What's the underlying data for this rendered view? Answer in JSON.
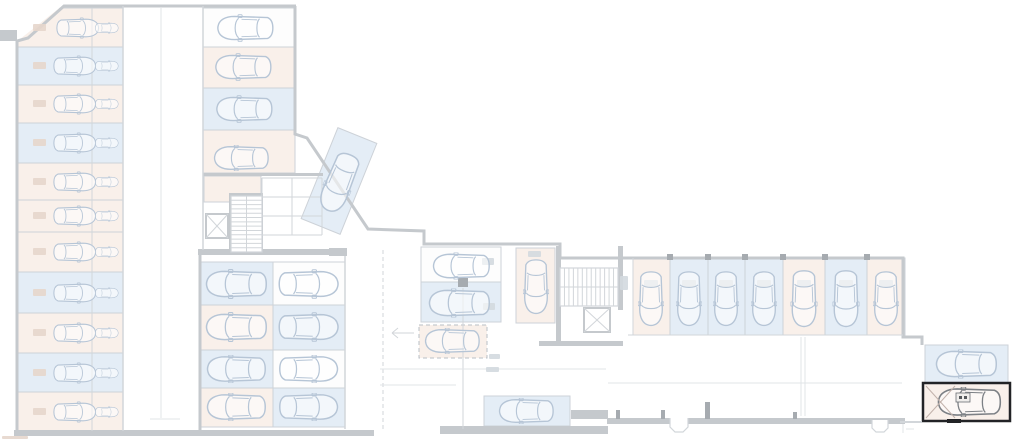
{
  "plan": {
    "kind": "underground-parking-floor-plan",
    "highlighted_space": {
      "present": true,
      "position": "bottom-right",
      "border_color": "#222326"
    }
  },
  "palette": {
    "wall": "#c5c9cd",
    "mid": "#d2d6da",
    "light": "#e1e4e7",
    "blue": "#e4edf6",
    "pink": "#f9f0ea",
    "white": "#fdfdfd",
    "carLight": "#b6c5d6",
    "carDark": "#7c8085",
    "highlight": "#222326",
    "hatch": "#c2b2ab",
    "smudgePink": "#e6d6cc",
    "smudgeGray": "#d3d9df",
    "column": "#a6abb0"
  },
  "spaces": [
    {
      "n": "left-r1",
      "x": 17,
      "y": 8,
      "w": 106,
      "h": 39,
      "f": "pink",
      "car": [
        78,
        28,
        44,
        28,
        0
      ],
      "car2": [
        107,
        28,
        24,
        24,
        0
      ],
      "sm": [
        33,
        24,
        13,
        7,
        "p"
      ]
    },
    {
      "n": "left-r2",
      "x": 17,
      "y": 47,
      "w": 106,
      "h": 38,
      "f": "blue",
      "car": [
        75,
        66,
        44,
        28,
        0
      ],
      "car2": [
        107,
        66,
        24,
        24,
        0
      ],
      "sm": [
        33,
        62,
        13,
        7,
        "p"
      ]
    },
    {
      "n": "left-r3",
      "x": 17,
      "y": 85,
      "w": 106,
      "h": 38,
      "f": "pink",
      "car": [
        75,
        104,
        44,
        28,
        0
      ],
      "car2": [
        107,
        104,
        24,
        24,
        0
      ],
      "sm": [
        33,
        100,
        13,
        7,
        "p"
      ]
    },
    {
      "n": "left-r4",
      "x": 17,
      "y": 123,
      "w": 106,
      "h": 40,
      "f": "blue",
      "car": [
        75,
        143,
        44,
        28,
        0
      ],
      "car2": [
        107,
        143,
        24,
        24,
        0
      ],
      "sm": [
        33,
        139,
        13,
        7,
        "p"
      ]
    },
    {
      "n": "left-r5",
      "x": 17,
      "y": 163,
      "w": 106,
      "h": 37,
      "f": "pink",
      "car": [
        75,
        182,
        44,
        28,
        0
      ],
      "car2": [
        107,
        182,
        24,
        24,
        0
      ],
      "sm": [
        33,
        178,
        13,
        7,
        "p"
      ]
    },
    {
      "n": "left-r6",
      "x": 17,
      "y": 200,
      "w": 106,
      "h": 32,
      "f": "pink",
      "car": [
        75,
        216,
        44,
        26,
        0
      ],
      "car2": [
        107,
        216,
        24,
        22,
        0
      ],
      "sm": [
        33,
        212,
        13,
        7,
        "p"
      ]
    },
    {
      "n": "left-r7",
      "x": 17,
      "y": 232,
      "w": 106,
      "h": 40,
      "f": "pink",
      "car": [
        75,
        252,
        44,
        28,
        0
      ],
      "car2": [
        107,
        252,
        24,
        24,
        0
      ],
      "sm": [
        33,
        248,
        13,
        7,
        "p"
      ]
    },
    {
      "n": "left-r8",
      "x": 17,
      "y": 272,
      "w": 106,
      "h": 41,
      "f": "blue",
      "car": [
        75,
        293,
        44,
        28,
        0
      ],
      "car2": [
        107,
        293,
        24,
        24,
        0
      ],
      "sm": [
        33,
        289,
        13,
        7,
        "p"
      ]
    },
    {
      "n": "left-r9",
      "x": 17,
      "y": 313,
      "w": 106,
      "h": 40,
      "f": "pink",
      "car": [
        75,
        333,
        44,
        28,
        0
      ],
      "car2": [
        107,
        333,
        24,
        24,
        0
      ],
      "sm": [
        33,
        329,
        13,
        7,
        "p"
      ]
    },
    {
      "n": "left-r10",
      "x": 17,
      "y": 353,
      "w": 106,
      "h": 39,
      "f": "blue",
      "car": [
        75,
        373,
        44,
        28,
        0
      ],
      "car2": [
        107,
        373,
        24,
        24,
        0
      ],
      "sm": [
        33,
        369,
        13,
        7,
        "p"
      ]
    },
    {
      "n": "left-r11",
      "x": 17,
      "y": 392,
      "w": 106,
      "h": 40,
      "f": "pink",
      "car": [
        75,
        412,
        44,
        28,
        0
      ],
      "car2": [
        107,
        412,
        24,
        24,
        0
      ],
      "sm": [
        33,
        408,
        13,
        7,
        "p"
      ]
    },
    {
      "n": "upper-r1",
      "x": 203,
      "y": 8,
      "w": 92,
      "h": 39,
      "f": "white",
      "car": [
        245,
        28,
        58,
        28,
        180
      ]
    },
    {
      "n": "upper-r2",
      "x": 203,
      "y": 47,
      "w": 92,
      "h": 41,
      "f": "pink",
      "car": [
        243,
        67,
        58,
        28,
        180
      ]
    },
    {
      "n": "upper-r3",
      "x": 203,
      "y": 88,
      "w": 92,
      "h": 42,
      "f": "blue",
      "car": [
        244,
        109,
        58,
        28,
        180
      ]
    },
    {
      "n": "upper-r4",
      "x": 203,
      "y": 130,
      "w": 92,
      "h": 43,
      "f": "pink",
      "car": [
        241,
        158,
        57,
        26,
        180
      ]
    },
    {
      "n": "store-room",
      "x": 204,
      "y": 176,
      "w": 57,
      "h": 26,
      "f": "pink"
    },
    {
      "n": "mid-left-r1",
      "x": 200,
      "y": 262,
      "w": 73,
      "h": 43,
      "f": "blue",
      "car": [
        236,
        284,
        63,
        30,
        180
      ]
    },
    {
      "n": "mid-left-r2",
      "x": 200,
      "y": 305,
      "w": 73,
      "h": 45,
      "f": "pink",
      "car": [
        236,
        327,
        63,
        30,
        180
      ]
    },
    {
      "n": "mid-left-r3",
      "x": 200,
      "y": 350,
      "w": 73,
      "h": 38,
      "f": "blue",
      "car": [
        236,
        369,
        63,
        28,
        180
      ]
    },
    {
      "n": "mid-left-r4",
      "x": 200,
      "y": 388,
      "w": 73,
      "h": 39,
      "f": "pink",
      "car": [
        236,
        407,
        63,
        28,
        180
      ]
    },
    {
      "n": "mid-right-r1",
      "x": 273,
      "y": 262,
      "w": 72,
      "h": 43,
      "f": "white",
      "car": [
        309,
        284,
        62,
        30,
        0
      ]
    },
    {
      "n": "mid-right-r2",
      "x": 273,
      "y": 305,
      "w": 72,
      "h": 45,
      "f": "blue",
      "car": [
        309,
        327,
        62,
        30,
        0
      ]
    },
    {
      "n": "mid-right-r3",
      "x": 273,
      "y": 350,
      "w": 72,
      "h": 38,
      "f": "white",
      "car": [
        309,
        369,
        62,
        28,
        0
      ]
    },
    {
      "n": "mid-right-r4",
      "x": 273,
      "y": 388,
      "w": 72,
      "h": 39,
      "f": "blue",
      "car": [
        309,
        407,
        62,
        28,
        0
      ]
    },
    {
      "n": "center-c1",
      "x": 421,
      "y": 247,
      "w": 80,
      "h": 35,
      "f": "white",
      "car": [
        461,
        266,
        62,
        27,
        180
      ],
      "sm": [
        482,
        258,
        12,
        7,
        "g"
      ]
    },
    {
      "n": "center-c2",
      "x": 421,
      "y": 282,
      "w": 80,
      "h": 40,
      "f": "blue",
      "car": [
        459,
        303,
        64,
        29,
        180
      ],
      "sm": [
        483,
        303,
        12,
        7,
        "g"
      ]
    },
    {
      "n": "center-c3",
      "x": 419,
      "y": 325,
      "w": 68,
      "h": 33,
      "f": "pink",
      "dash": true,
      "car": [
        452,
        341,
        62,
        26,
        180
      ]
    },
    {
      "n": "center-c4",
      "x": 516,
      "y": 248,
      "w": 39,
      "h": 75,
      "f": "pink",
      "car": [
        536,
        287,
        63,
        26,
        90
      ],
      "sm": [
        528,
        251,
        13,
        6,
        "g"
      ]
    },
    {
      "n": "diagonal",
      "x": 318,
      "y": 132,
      "w": 42,
      "h": 98,
      "f": "blue",
      "rot": 22,
      "car": [
        339,
        183,
        66,
        29,
        112
      ]
    },
    {
      "n": "wing-1",
      "x": 633,
      "y": 258,
      "w": 37,
      "h": 77,
      "f": "pink",
      "car": [
        651,
        299,
        62,
        26,
        90
      ],
      "sm": [
        644,
        280,
        14,
        7,
        "g"
      ]
    },
    {
      "n": "wing-2",
      "x": 670,
      "y": 258,
      "w": 38,
      "h": 77,
      "f": "blue",
      "car": [
        689,
        299,
        62,
        26,
        90
      ],
      "sm": [
        682,
        280,
        14,
        7,
        "g"
      ]
    },
    {
      "n": "wing-3",
      "x": 708,
      "y": 258,
      "w": 37,
      "h": 77,
      "f": "blue",
      "car": [
        726,
        299,
        62,
        26,
        90
      ],
      "sm": [
        719,
        280,
        14,
        7,
        "g"
      ]
    },
    {
      "n": "wing-4",
      "x": 745,
      "y": 258,
      "w": 38,
      "h": 77,
      "f": "blue",
      "car": [
        764,
        299,
        62,
        26,
        90
      ],
      "sm": [
        757,
        280,
        14,
        7,
        "g"
      ]
    },
    {
      "n": "wing-5",
      "x": 783,
      "y": 258,
      "w": 42,
      "h": 77,
      "f": "pink",
      "car": [
        804,
        299,
        62,
        27,
        90
      ],
      "sm": [
        797,
        280,
        14,
        7,
        "g"
      ]
    },
    {
      "n": "wing-6",
      "x": 825,
      "y": 258,
      "w": 42,
      "h": 77,
      "f": "blue",
      "car": [
        846,
        299,
        62,
        27,
        90
      ],
      "sm": [
        839,
        280,
        14,
        7,
        "g"
      ]
    },
    {
      "n": "wing-7",
      "x": 867,
      "y": 258,
      "w": 38,
      "h": 77,
      "f": "pink",
      "car": [
        886,
        299,
        62,
        26,
        90
      ],
      "sm": [
        879,
        280,
        14,
        7,
        "g"
      ]
    },
    {
      "n": "bottom-b1",
      "x": 484,
      "y": 396,
      "w": 86,
      "h": 30,
      "f": "blue",
      "car": [
        526,
        411,
        66,
        26,
        180
      ]
    },
    {
      "n": "right-r1",
      "x": 925,
      "y": 345,
      "w": 83,
      "h": 38,
      "f": "blue",
      "car": [
        966,
        364,
        70,
        29,
        180
      ]
    },
    {
      "n": "right-r2-selected",
      "x": 923,
      "y": 383,
      "w": 87,
      "h": 38,
      "f": "pink",
      "hl": true,
      "car": [
        969,
        402,
        72,
        30,
        180,
        "dark"
      ]
    }
  ],
  "stairs": [
    {
      "n": "stairs-core-left",
      "x": 231,
      "y": 196,
      "w": 31,
      "h": 56,
      "dir": "v",
      "steps": 13
    },
    {
      "n": "stairs-core-right",
      "x": 560,
      "y": 268,
      "w": 58,
      "h": 38,
      "dir": "h",
      "steps": 13
    }
  ],
  "elevators": [
    {
      "n": "elevator-left",
      "x": 206,
      "y": 214,
      "w": 22,
      "h": 24
    },
    {
      "n": "elevator-right",
      "x": 584,
      "y": 308,
      "w": 26,
      "h": 24
    }
  ],
  "wall_rects": [
    [
      0,
      30,
      17,
      11
    ],
    [
      198,
      249,
      149,
      6
    ],
    [
      329,
      248,
      18,
      8
    ],
    [
      14,
      430,
      360,
      6
    ],
    [
      440,
      426,
      168,
      8
    ],
    [
      571,
      410,
      37,
      9
    ],
    [
      607,
      418,
      298,
      6
    ],
    [
      539,
      341,
      84,
      5
    ],
    [
      556,
      246,
      5,
      99
    ],
    [
      618,
      246,
      5,
      64
    ],
    [
      229,
      193,
      34,
      3
    ],
    [
      229,
      193,
      3,
      62
    ],
    [
      260,
      193,
      3,
      62
    ],
    [
      203,
      173,
      120,
      3
    ]
  ],
  "lines": [
    [
      92,
      8,
      92,
      431,
      "m",
      1
    ],
    [
      123,
      6,
      123,
      431,
      "m",
      1.5
    ],
    [
      203,
      6,
      203,
      250,
      "m",
      1.5
    ],
    [
      161,
      8,
      161,
      418,
      "l",
      1
    ],
    [
      150,
      419,
      180,
      419,
      "l",
      1
    ],
    [
      345,
      256,
      345,
      429,
      "m",
      1.5
    ],
    [
      383,
      250,
      383,
      429,
      "m",
      1,
      "4,3"
    ],
    [
      463,
      288,
      463,
      429,
      "m",
      1
    ],
    [
      380,
      369,
      606,
      369,
      "l",
      1
    ],
    [
      380,
      385,
      456,
      385,
      "l",
      1
    ],
    [
      608,
      383,
      902,
      383,
      "l",
      1
    ],
    [
      801,
      337,
      801,
      416,
      "l",
      1
    ],
    [
      805,
      337,
      805,
      416,
      "l",
      1
    ],
    [
      900,
      422,
      922,
      422,
      "m",
      2
    ],
    [
      392,
      333,
      414,
      333,
      "m",
      1
    ],
    [
      392,
      333,
      398,
      328,
      "m",
      1
    ],
    [
      392,
      333,
      398,
      338,
      "m",
      1
    ],
    [
      628,
      335,
      903,
      335,
      "m",
      1
    ],
    [
      633,
      258,
      633,
      335,
      "m",
      1
    ],
    [
      262,
      178,
      262,
      235,
      "m",
      1
    ],
    [
      292,
      178,
      292,
      235,
      "m",
      1
    ],
    [
      322,
      178,
      322,
      235,
      "m",
      1
    ],
    [
      262,
      178,
      322,
      178,
      "m",
      1
    ],
    [
      262,
      197,
      322,
      197,
      "m",
      1
    ],
    [
      262,
      216,
      322,
      216,
      "m",
      1
    ],
    [
      262,
      235,
      322,
      235,
      "m",
      1
    ],
    [
      903,
      424,
      903,
      433,
      "l",
      1
    ],
    [
      906,
      429,
      914,
      429,
      "l",
      1
    ]
  ],
  "columns": [
    [
      458,
      278,
      10,
      9
    ],
    [
      667,
      254,
      6,
      6
    ],
    [
      705,
      254,
      6,
      6
    ],
    [
      742,
      254,
      6,
      6
    ],
    [
      780,
      254,
      6,
      6
    ],
    [
      822,
      254,
      6,
      6
    ],
    [
      864,
      254,
      6,
      6
    ],
    [
      616,
      410,
      4,
      9
    ],
    [
      661,
      410,
      4,
      9
    ],
    [
      705,
      402,
      5,
      17
    ],
    [
      793,
      412,
      4,
      7
    ]
  ],
  "fixtures": [
    "M670,418 v9 l5,5 h8 l5,-5 v-9",
    "M872,420 v8 l4,4 h8 l4,-4 v-8"
  ],
  "smudges_extra": [
    [
      489,
      354,
      11,
      5,
      "g"
    ],
    [
      486,
      367,
      13,
      5,
      "g"
    ],
    [
      2,
      436,
      26,
      3,
      "p"
    ],
    [
      620,
      276,
      8,
      14,
      "g"
    ]
  ],
  "highlight_extras": {
    "hatch": [
      [
        926,
        386,
        955,
        418
      ],
      [
        926,
        418,
        955,
        386
      ]
    ],
    "plate": {
      "x": 956,
      "y": 393,
      "w": 14,
      "h": 9
    },
    "plate_dots": [
      [
        959,
        396,
        3,
        3
      ],
      [
        964,
        396,
        3,
        3
      ]
    ],
    "tick": {
      "x": 947,
      "y": 419,
      "w": 14,
      "h": 4
    }
  }
}
